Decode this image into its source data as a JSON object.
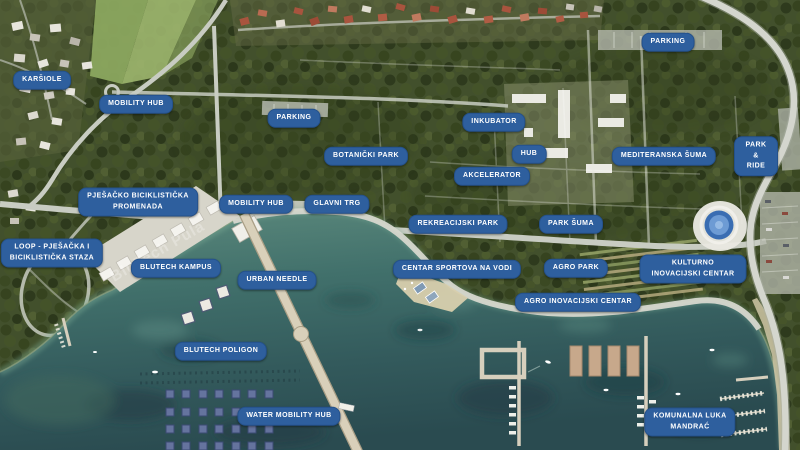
{
  "map": {
    "type": "aerial-masterplan-render",
    "colors": {
      "label_background": "#2e5f9e",
      "label_text": "#ffffff",
      "forest": "#42502c",
      "water_deep": "#2a4b50",
      "water_shallow": "#5d8a7d",
      "road": "#c8ccc2",
      "pier": "#d9d0ba"
    }
  },
  "ground_text": {
    "promenade": "BluTech Pula"
  },
  "labels": [
    {
      "id": "karsiole",
      "text": "KARŠIOLE"
    },
    {
      "id": "mobility-hub-north",
      "text": "MOBILITY HUB"
    },
    {
      "id": "parking-west",
      "text": "PARKING"
    },
    {
      "id": "botanicki-park",
      "text": "BOTANIČKI PARK"
    },
    {
      "id": "pjesacko-biciklisticka-promenada",
      "text": "PJEŠAČKO BICIKLISTIČKA\nPROMENADA"
    },
    {
      "id": "mobility-hub-central",
      "text": "MOBILITY HUB"
    },
    {
      "id": "glavni-trg",
      "text": "GLAVNI TRG"
    },
    {
      "id": "parking-north",
      "text": "PARKING"
    },
    {
      "id": "inkubator",
      "text": "INKUBATOR"
    },
    {
      "id": "hub",
      "text": "HUB"
    },
    {
      "id": "mediteranska-suma",
      "text": "MEDITERANSKA ŠUMA"
    },
    {
      "id": "park-and-ride",
      "text": "PARK & RIDE"
    },
    {
      "id": "akcelerator",
      "text": "AKCELERATOR"
    },
    {
      "id": "rekreacijski-park",
      "text": "REKREACIJSKI PARK"
    },
    {
      "id": "park-suma",
      "text": "PARK ŠUMA"
    },
    {
      "id": "loop-pjesacka-biciklisticka-staza",
      "text": "LOOP - PJEŠAČKA I\nBICIKLISTIČKA STAZA"
    },
    {
      "id": "blutech-kampus",
      "text": "BLUTECH KAMPUS"
    },
    {
      "id": "urban-needle",
      "text": "URBAN NEEDLE"
    },
    {
      "id": "centar-sportova-na-vodi",
      "text": "CENTAR SPORTOVA NA VODI"
    },
    {
      "id": "agro-park",
      "text": "AGRO PARK"
    },
    {
      "id": "kulturno-inovacijski-centar",
      "text": "KULTURNO INOVACIJSKI CENTAR"
    },
    {
      "id": "agro-inovacijski-centar",
      "text": "AGRO INOVACIJSKI CENTAR"
    },
    {
      "id": "blutech-poligon",
      "text": "BLUTECH POLIGON"
    },
    {
      "id": "water-mobility-hub",
      "text": "WATER MOBILITY HUB"
    },
    {
      "id": "komunalna-luka-mandrac",
      "text": "KOMUNALNA LUKA\nMANDRAĆ"
    }
  ]
}
